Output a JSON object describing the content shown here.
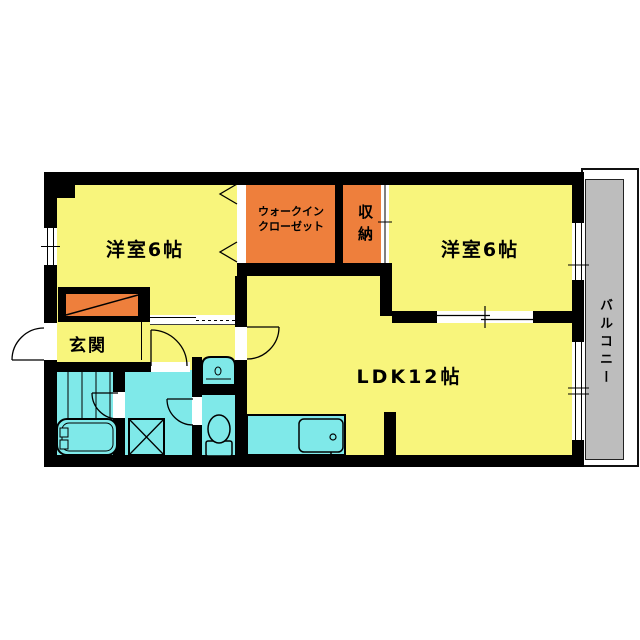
{
  "floorplan": {
    "rooms": {
      "bedroom1": {
        "label": "洋室6帖"
      },
      "bedroom2": {
        "label": "洋室6帖"
      },
      "wic": {
        "line1": "ウォークイン",
        "line2": "クローゼット"
      },
      "storage": {
        "label": "収納"
      },
      "entrance": {
        "label": "玄関"
      },
      "ldk": {
        "label": "LDK12帖"
      },
      "balcony": {
        "label": "バルコニー"
      }
    },
    "colors": {
      "room_yellow": "#f8f57c",
      "closet_orange": "#ee7f3c",
      "wet_area_cyan": "#7fe9e9",
      "balcony_gray": "#bdbdbd",
      "wall_black": "#000000"
    }
  }
}
